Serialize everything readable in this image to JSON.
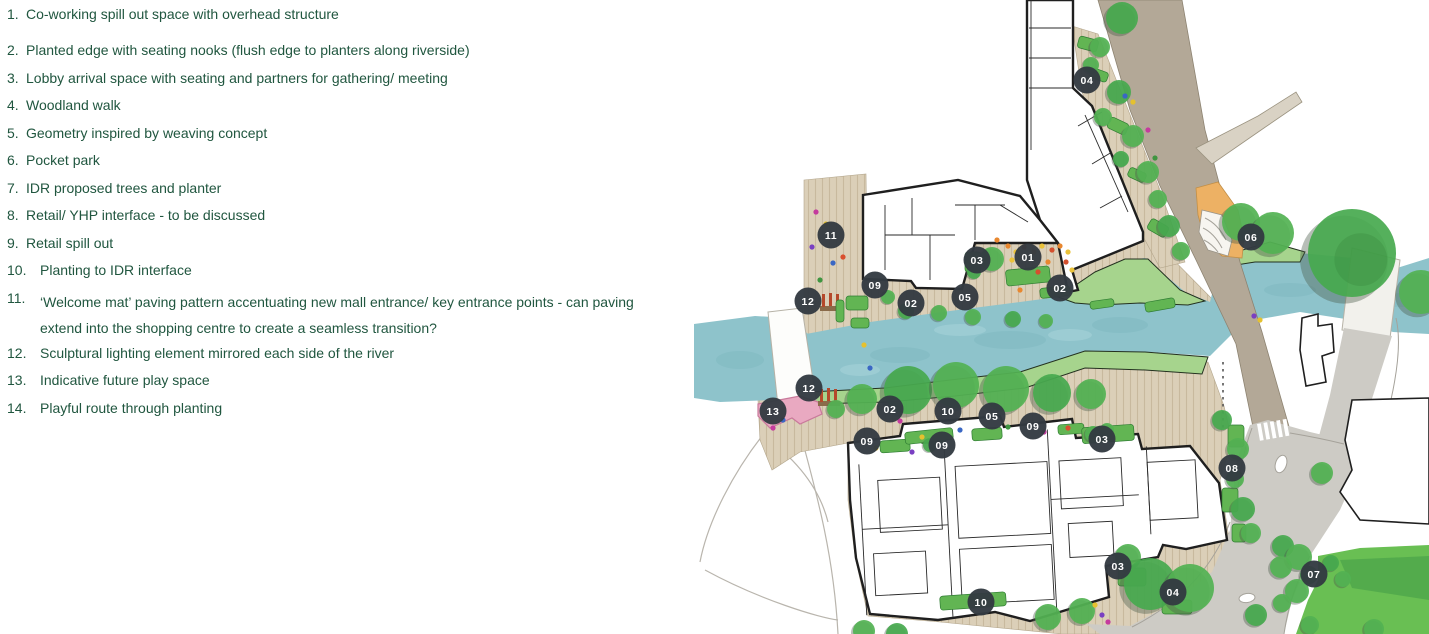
{
  "legend": {
    "items": [
      {
        "num": "1.",
        "text": "Co-working spill out space with overhead structure"
      },
      {
        "num": "2.",
        "text": "Planted edge with seating nooks (flush edge to planters along riverside)"
      },
      {
        "num": "3.",
        "text": "Lobby arrival space with seating and partners for gathering/ meeting"
      },
      {
        "num": "4.",
        "text": "Woodland walk"
      },
      {
        "num": "5.",
        "text": "Geometry inspired by weaving concept"
      },
      {
        "num": "6.",
        "text": "Pocket park"
      },
      {
        "num": "7.",
        "text": "IDR proposed trees and planter"
      },
      {
        "num": "8.",
        "text": "Retail/ YHP interface - to be discussed"
      },
      {
        "num": "9.",
        "text": "Retail spill out"
      },
      {
        "num": "10.",
        "text": "Planting to IDR interface"
      },
      {
        "num": "11.",
        "text": "‘Welcome mat’ paving pattern accentuating new mall entrance/ key entrance points - can paving extend into the shopping centre to create a seamless transition?"
      },
      {
        "num": "12.",
        "text": "Sculptural lighting element mirrored each side of the river"
      },
      {
        "num": "13.",
        "text": "Indicative future play space"
      },
      {
        "num": "14.",
        "text": "Playful route through planting"
      }
    ]
  },
  "map": {
    "markers": [
      {
        "label": "04",
        "x": 1087,
        "y": 80
      },
      {
        "label": "11",
        "x": 831,
        "y": 235
      },
      {
        "label": "03",
        "x": 977,
        "y": 260
      },
      {
        "label": "01",
        "x": 1028,
        "y": 257
      },
      {
        "label": "02",
        "x": 1060,
        "y": 288
      },
      {
        "label": "09",
        "x": 875,
        "y": 285
      },
      {
        "label": "02",
        "x": 911,
        "y": 303
      },
      {
        "label": "05",
        "x": 965,
        "y": 297
      },
      {
        "label": "12",
        "x": 808,
        "y": 301
      },
      {
        "label": "06",
        "x": 1251,
        "y": 237
      },
      {
        "label": "12",
        "x": 809,
        "y": 388
      },
      {
        "label": "13",
        "x": 773,
        "y": 411
      },
      {
        "label": "02",
        "x": 890,
        "y": 409
      },
      {
        "label": "10",
        "x": 948,
        "y": 411
      },
      {
        "label": "05",
        "x": 992,
        "y": 416
      },
      {
        "label": "09",
        "x": 1033,
        "y": 426
      },
      {
        "label": "09",
        "x": 867,
        "y": 441
      },
      {
        "label": "09",
        "x": 942,
        "y": 445
      },
      {
        "label": "03",
        "x": 1102,
        "y": 439
      },
      {
        "label": "08",
        "x": 1232,
        "y": 468
      },
      {
        "label": "03",
        "x": 1118,
        "y": 566
      },
      {
        "label": "04",
        "x": 1173,
        "y": 592
      },
      {
        "label": "10",
        "x": 981,
        "y": 602
      },
      {
        "label": "07",
        "x": 1314,
        "y": 574
      }
    ]
  },
  "colors": {
    "legend_text": "#20563f",
    "marker_bg": "#333a42",
    "marker_text": "#ffffff",
    "river": "#8ec3cb",
    "bank_green": "#a6d48d",
    "deck": "#dbcfb8",
    "road_upper": "#b3a897",
    "road_lower": "#cdcbc5",
    "tree_green": "#53b253",
    "lawn": "#69bf53",
    "pocket_orange": "#edb164",
    "play_pink": "#e9a9c1",
    "building_outline": "#1f1f1f"
  }
}
